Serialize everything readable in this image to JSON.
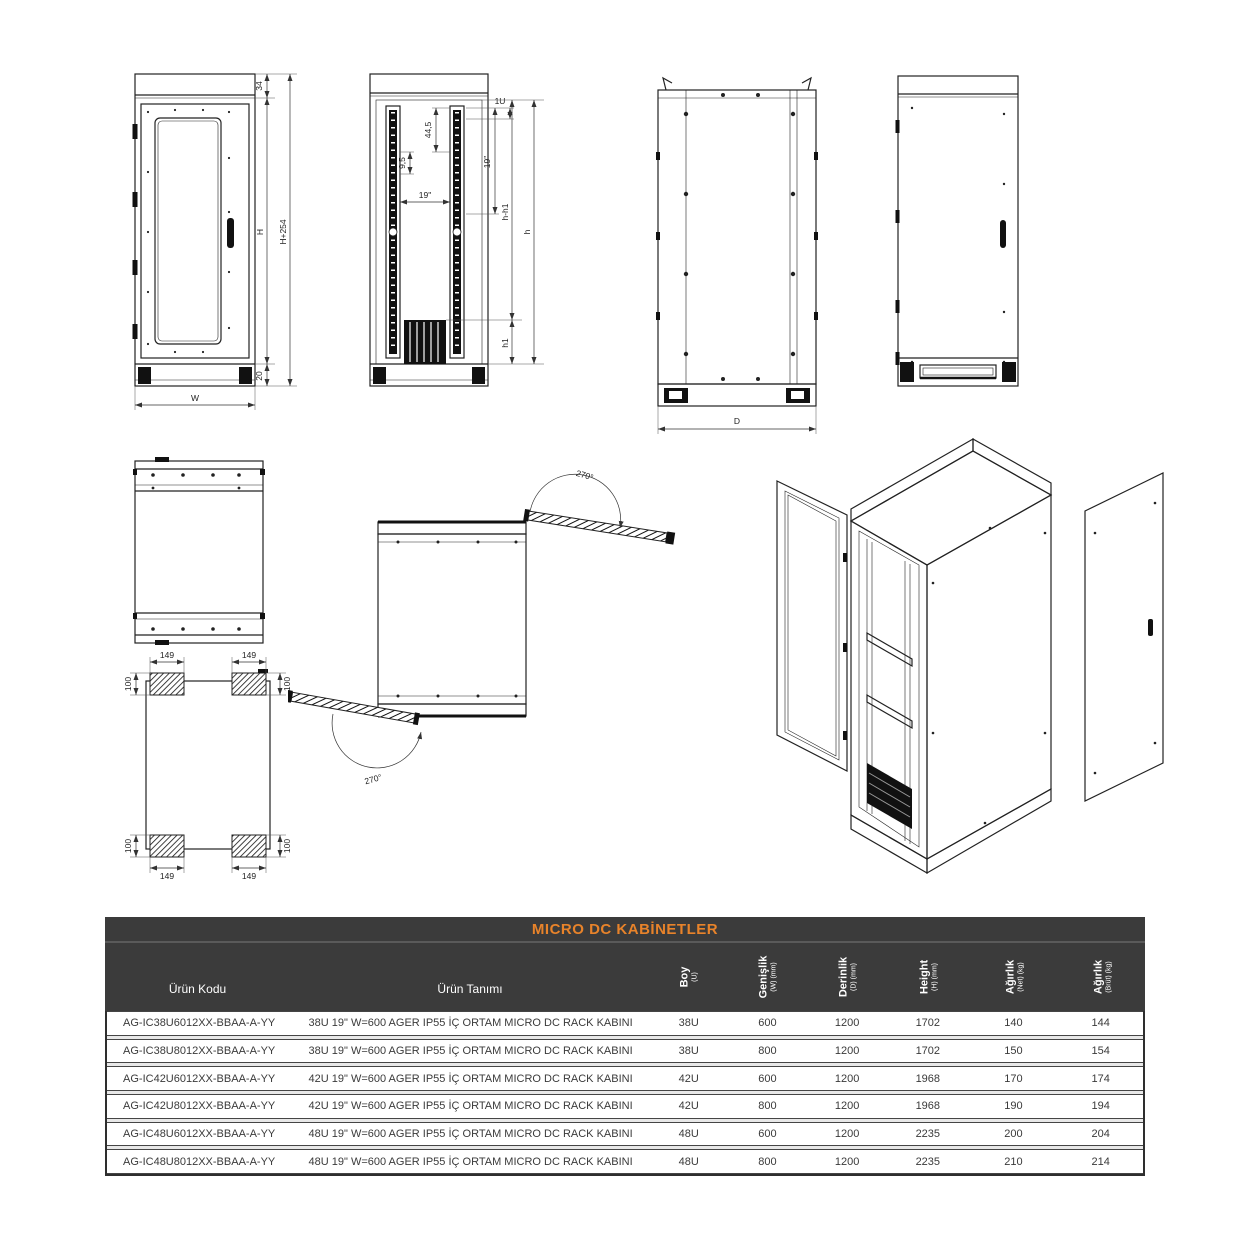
{
  "drawings": {
    "front_view": {
      "dim_top_frame": "34",
      "dim_body_height": "H",
      "dim_total_height": "H+254",
      "dim_plinth_height": "20",
      "dim_width": "W"
    },
    "rack_view": {
      "dim_unit_height": "1U",
      "dim_pitch": "44,5",
      "dim_rail_height": "19\"",
      "dim_hole_pitch": "9,5",
      "dim_rail_span": "19\"",
      "dim_usable_height": "h-h1",
      "dim_total_height": "h",
      "dim_base_height": "h1"
    },
    "side_view": {
      "dim_depth": "D"
    },
    "base_view": {
      "dim_foot_length": "149",
      "dim_foot_width": "100"
    },
    "door_swing": {
      "dim_rear_angle": "270°",
      "dim_front_angle": "270°"
    }
  },
  "table": {
    "title": "MICRO DC KABİNETLER",
    "columns": [
      {
        "label": "Ürün Kodu"
      },
      {
        "label": "Ürün Tanımı"
      },
      {
        "label": "Boy",
        "sub": "(U)"
      },
      {
        "label": "Genişlik",
        "sub": "(W) (mm)"
      },
      {
        "label": "Derinlik",
        "sub": "(D) (mm)"
      },
      {
        "label": "Height",
        "sub": "(H) (mm)"
      },
      {
        "label": "Ağırlık",
        "sub": "(Net) (kg)"
      },
      {
        "label": "Ağırlık",
        "sub": "(Brüt) (kg)"
      }
    ],
    "rows": [
      {
        "code": "AG-IC38U6012XX-BBAA-A-YY",
        "desc": "38U 19\" W=600 AGER IP55 İÇ ORTAM MICRO DC RACK KABINI",
        "boy": "38U",
        "genislik": "600",
        "derinlik": "1200",
        "height": "1702",
        "net": "140",
        "brut": "144"
      },
      {
        "code": "AG-IC38U8012XX-BBAA-A-YY",
        "desc": "38U 19\" W=600 AGER IP55 İÇ ORTAM MICRO DC RACK KABINI",
        "boy": "38U",
        "genislik": "800",
        "derinlik": "1200",
        "height": "1702",
        "net": "150",
        "brut": "154"
      },
      {
        "code": "AG-IC42U6012XX-BBAA-A-YY",
        "desc": "42U 19\" W=600 AGER IP55 İÇ ORTAM MICRO DC RACK KABINI",
        "boy": "42U",
        "genislik": "600",
        "derinlik": "1200",
        "height": "1968",
        "net": "170",
        "brut": "174"
      },
      {
        "code": "AG-IC42U8012XX-BBAA-A-YY",
        "desc": "42U 19\" W=600 AGER IP55 İÇ ORTAM MICRO DC RACK KABINI",
        "boy": "42U",
        "genislik": "800",
        "derinlik": "1200",
        "height": "1968",
        "net": "190",
        "brut": "194"
      },
      {
        "code": "AG-IC48U6012XX-BBAA-A-YY",
        "desc": "48U 19\" W=600 AGER IP55 İÇ ORTAM MICRO DC RACK KABINI",
        "boy": "48U",
        "genislik": "600",
        "derinlik": "1200",
        "height": "2235",
        "net": "200",
        "brut": "204"
      },
      {
        "code": "AG-IC48U8012XX-BBAA-A-YY",
        "desc": "48U 19\" W=600 AGER IP55 İÇ ORTAM MICRO DC RACK KABINI",
        "boy": "48U",
        "genislik": "800",
        "derinlik": "1200",
        "height": "2235",
        "net": "210",
        "brut": "214"
      }
    ],
    "colors": {
      "accent_orange": "#E8832A",
      "header_dark": "#3B3B3B",
      "line_color": "#222222"
    }
  }
}
